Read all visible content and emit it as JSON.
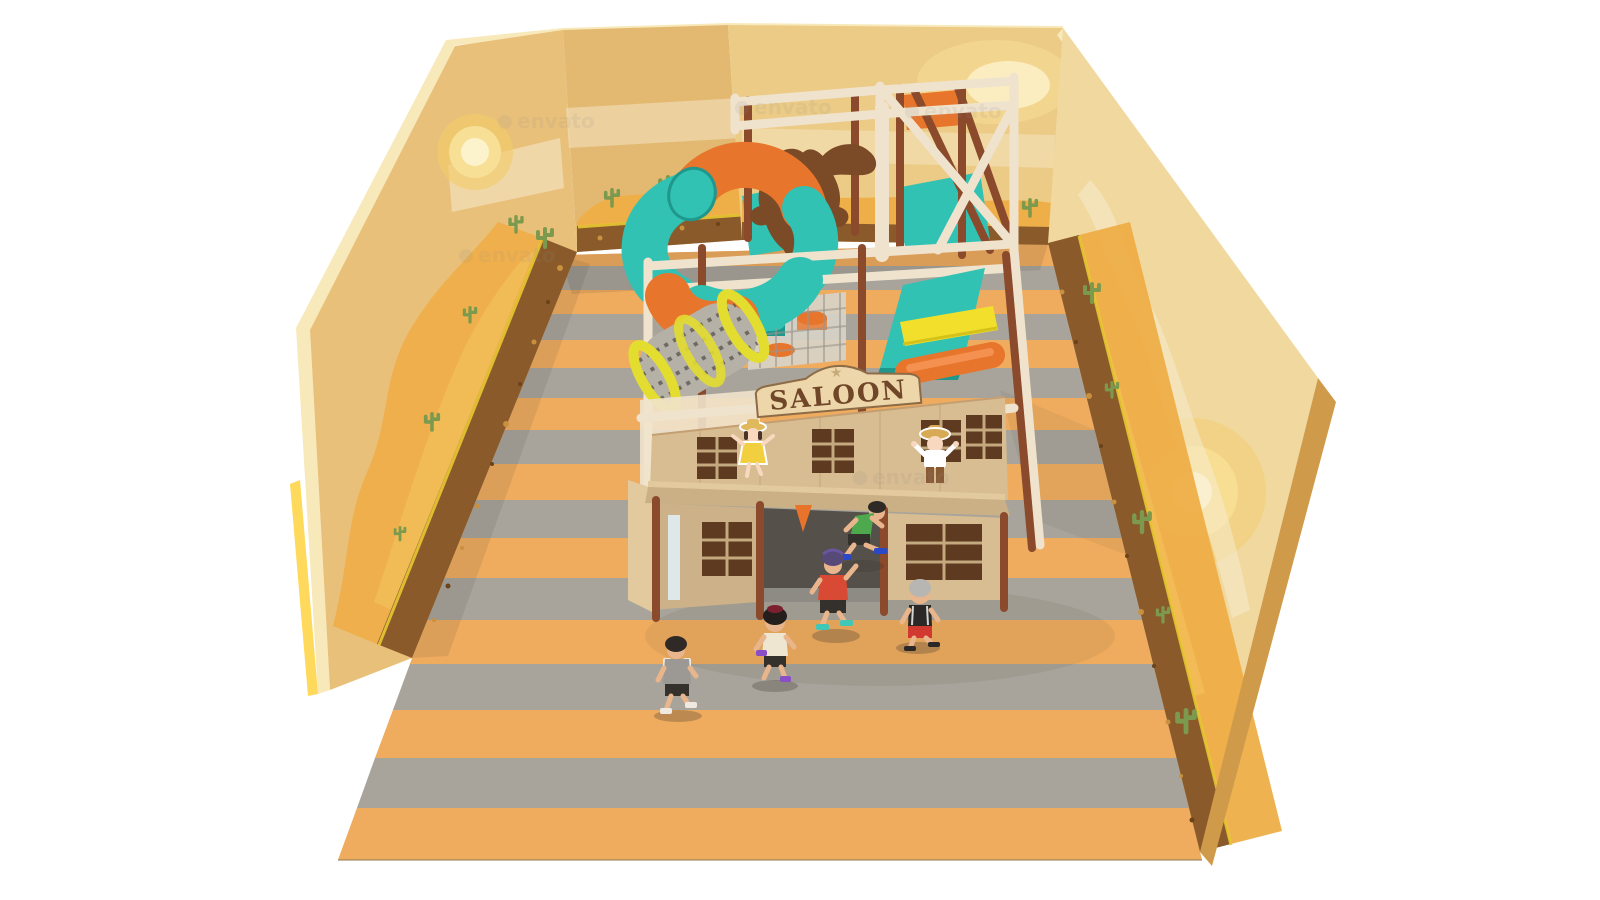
{
  "scene": {
    "type": "3d-render",
    "subject": "indoor soft-play playground",
    "theme": "wild west saloon with desert murals"
  },
  "signage": {
    "sign_text": "SALOON",
    "star_glyph": "★"
  },
  "watermark": {
    "text": "envato"
  },
  "decor": {
    "longhorn": "brown bull head silhouette mounted on top frame",
    "murals": "desert walls with sun, clouds, dunes, cacti and soil band",
    "floor": "alternating orange and gray stripes",
    "play_elements": "orange-teal spiral tube slide, yellow-ring mesh tunnel, teal platforms, yellow slide, orange roller slide, teal and orange stools"
  },
  "children": [
    {
      "id": "boy-gray-shirt",
      "location": "front-left",
      "hair": "black",
      "shirt": "gray with white sleeves",
      "shorts": "black",
      "shoes": "white"
    },
    {
      "id": "girl-cream-top",
      "location": "center",
      "hair": "black bob with dark red cap",
      "shirt": "cream",
      "shorts": "black",
      "shoes": "purple"
    },
    {
      "id": "boy-red-shirt",
      "location": "center facing saloon",
      "hair": "black with purple cap",
      "shirt": "red",
      "shorts": "black",
      "shoes": "teal"
    },
    {
      "id": "boy-green-tank",
      "location": "running through saloon doorway",
      "shirt": "green tank",
      "shorts": "black",
      "shoes": "blue"
    },
    {
      "id": "kid-gray-hair",
      "location": "right of entrance",
      "hair": "gray",
      "shirt": "black",
      "shorts": "red",
      "shoes": "black sandals"
    }
  ],
  "cutouts": [
    {
      "id": "cowgirl-yellow-dress",
      "hat": "straw hat",
      "dress": "yellow"
    },
    {
      "id": "cowboy-red-bandana",
      "hat": "cowboy hat",
      "shirt": "white",
      "bandana": "red",
      "pants": "brown"
    }
  ],
  "palette": {
    "bg_white": "#ffffff",
    "wall_left": "#e9c07a",
    "wall_step": "#e3b972",
    "wall_back": "#eccb86",
    "wall_right": "#f1d89f",
    "wall_rim": "#f8e9bb",
    "wall_rim_gold": "#ffd23e",
    "wall_bevel": "#cf9b4a",
    "mural_cloud": "#f7eed4",
    "mural_dune": "#eeae48",
    "mural_dune_light": "#f4c55c",
    "mural_soil": "#8a5a2b",
    "mural_soil_dot": "#c8913f",
    "mural_soil_dot2": "#6b4318",
    "mural_soil_line": "#e9c832",
    "cactus": "#7c9a4e",
    "sun_outer": "#f2cb68",
    "sun_mid": "#f7df95",
    "sun_core": "#fcf3cd",
    "floor_orange": "#efac5f",
    "floor_gray": "#a8a49b",
    "floor_line": "#8a7a55",
    "shadow": "#3a332c",
    "frame_cream": "#f0e3cd",
    "post_brown": "#8a4a2b",
    "platform_teal": "#31c2b4",
    "teal_dark": "#1f978c",
    "slide_orange": "#e8752c",
    "orange_hi": "#f49050",
    "slide_yellow": "#f2df2b",
    "yellow_dark": "#d4c21a",
    "mesh_gray": "#b6b1a7",
    "mesh_dark": "#57534c",
    "mesh_ring": "#e3dd2f",
    "mesh_panel": "#d8d3c8",
    "bull_brown": "#7b4a26",
    "facade": "#d8bc92",
    "facade_shade": "#cdb189",
    "facade_line": "#c49f72",
    "sign_board": "#ecd6aa",
    "sign_border": "#8d6b46",
    "sign_text_color": "#6f4628",
    "sign_star": "#c8ab79",
    "window_dark": "#5d3a20",
    "window_frame": "#c4a87e",
    "entrance_dark": "#55504a",
    "entrance_floor": "#8e8a84",
    "porch_front": "#cbb086",
    "porch_top": "#e2c99e",
    "door_glass": "#dfe8e8",
    "pennant": "#e8732a",
    "cutout_outline": "#ffffff",
    "girl_dress": "#f2cf3e",
    "straw_hat": "#e0b95c",
    "boy_hat": "#d9aa55",
    "bandana": "#d8402c",
    "boy_pants": "#8a5a35",
    "cutout_skin": "#f8d9c0",
    "hair_dark": "#4a3428",
    "kid_skin": "#e9b58c",
    "hair_black": "#2f2a26",
    "kid_a_shirt": "#9c9893",
    "kid_sleeve_white": "#eceae4",
    "kid_shorts_dark": "#34302b",
    "kid_shoe_white": "#efe9e2",
    "kid_b_top": "#efe6d2",
    "kid_b_cap": "#7c2030",
    "kid_b_shoe": "#8a4fc8",
    "kid_c_shirt": "#d84a34",
    "kid_c_cap": "#584a78",
    "kid_c_shoe": "#3fc8b8",
    "kid_d_top": "#4da84e",
    "kid_d_shoe": "#2a48c8",
    "kid_e_hair": "#b8b6b2",
    "kid_e_top": "#2b2825",
    "kid_e_shorts": "#d03830",
    "watermark_color": "#8f8f8f"
  }
}
